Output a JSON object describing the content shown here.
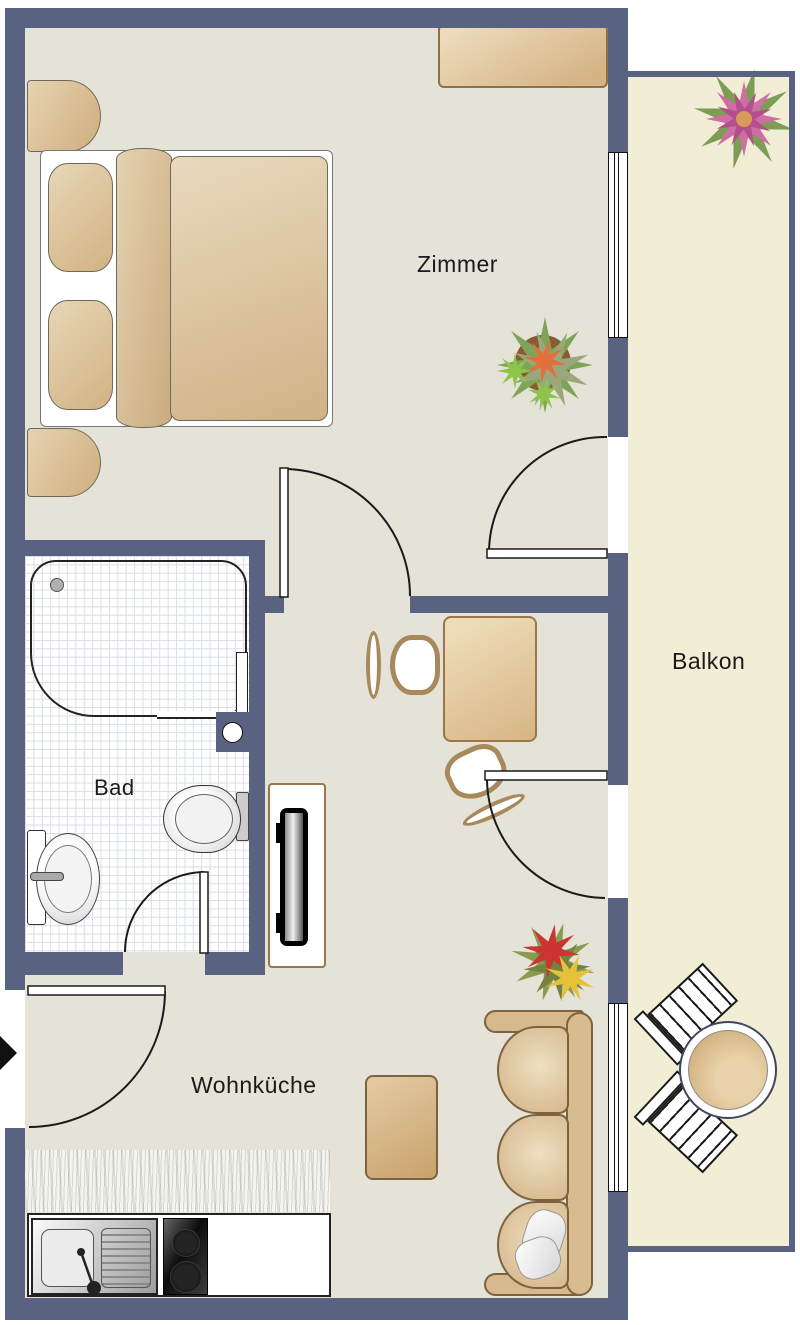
{
  "title": "Apartment floor plan",
  "rooms": {
    "zimmer": {
      "label": "Zimmer"
    },
    "bad": {
      "label": "Bad"
    },
    "wohnkueche": {
      "label": "Wohnküche"
    },
    "balkon": {
      "label": "Balkon"
    }
  },
  "colors": {
    "wall": "#5a6282",
    "room_floor": "#e5e2d8",
    "bathroom_tile": "#ffffff",
    "balcony_floor": "#f2eed5",
    "furniture_tan": "#d9bc90",
    "furniture_outline": "#7d6240",
    "door_line": "#1a1a1a",
    "plant_green": "#7d9c55",
    "flower_pink": "#cf6da6",
    "flower_red": "#cc3431",
    "flower_yellow": "#e6c23a"
  },
  "icons": {
    "entrance_arrow": "entrance-direction-marker"
  }
}
